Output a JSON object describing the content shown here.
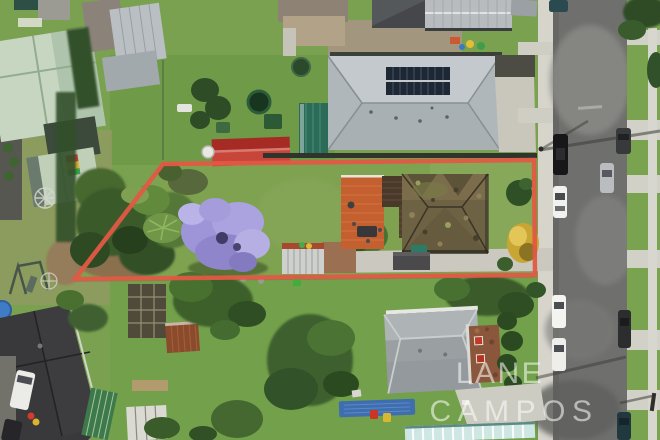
{
  "watermark": {
    "line1": "LANE",
    "line2": "CAMPOS"
  },
  "colors": {
    "boundary": "#e25844",
    "watermark": "#ffffff",
    "road": "#6f6f6d",
    "footpath": "#d6d4cb",
    "grass": "#79a150",
    "jacaranda": "#9d95d7",
    "solar_house_roof": "#b6bcc0",
    "solar_panels": "#1e2734",
    "subject_roof": "#6e6244",
    "terracotta_courtyard": "#c4602f",
    "red_shed": "#c8453a",
    "teal_shed": "#2d6b59",
    "mint_roof": "#c7d6c1",
    "charcoal_roof": "#39393b",
    "neighbor_roof_gray": "#9aa0a2"
  }
}
